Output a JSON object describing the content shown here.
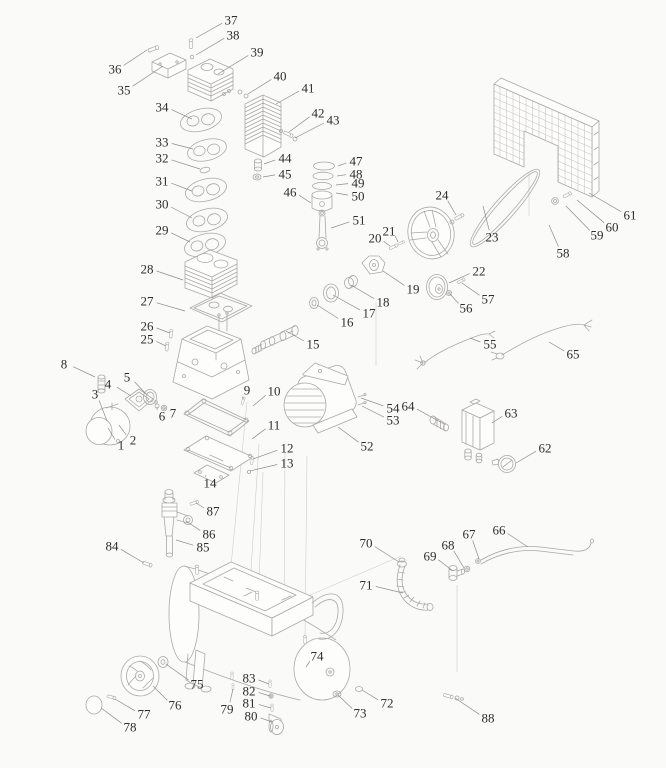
{
  "diagram": {
    "description_text": "",
    "background": "#fafaf8",
    "ink": "#aba9a6",
    "leader_color": "#8f8d8b",
    "label_color": "#2f2e2c",
    "part_labels": [
      {
        "n": "1",
        "x": 121,
        "y": 445,
        "tx": 108,
        "ty": 428
      },
      {
        "n": "2",
        "x": 133,
        "y": 440,
        "tx": 119,
        "ty": 425
      },
      {
        "n": "3",
        "x": 95,
        "y": 394,
        "tx": 107,
        "ty": 421
      },
      {
        "n": "4",
        "x": 108,
        "y": 384,
        "tx": 131,
        "ty": 396
      },
      {
        "n": "5",
        "x": 127,
        "y": 377,
        "tx": 146,
        "ty": 394
      },
      {
        "n": "6",
        "x": 162,
        "y": 416,
        "tx": 157,
        "ty": 407
      },
      {
        "n": "7",
        "x": 173,
        "y": 413,
        "tx": 165,
        "ty": 408
      },
      {
        "n": "8",
        "x": 64,
        "y": 364,
        "tx": 95,
        "ty": 377
      },
      {
        "n": "9",
        "x": 247,
        "y": 390,
        "tx": 243,
        "ty": 399
      },
      {
        "n": "10",
        "x": 274,
        "y": 391,
        "tx": 253,
        "ty": 406
      },
      {
        "n": "11",
        "x": 274,
        "y": 425,
        "tx": 252,
        "ty": 439
      },
      {
        "n": "12",
        "x": 287,
        "y": 448,
        "tx": 253,
        "ty": 459
      },
      {
        "n": "13",
        "x": 287,
        "y": 463,
        "tx": 250,
        "ty": 471
      },
      {
        "n": "14",
        "x": 210,
        "y": 483,
        "tx": 206,
        "ty": 475
      },
      {
        "n": "15",
        "x": 313,
        "y": 344,
        "tx": 286,
        "ty": 331
      },
      {
        "n": "16",
        "x": 347,
        "y": 322,
        "tx": 317,
        "ty": 305
      },
      {
        "n": "17",
        "x": 369,
        "y": 313,
        "tx": 333,
        "ty": 295
      },
      {
        "n": "18",
        "x": 383,
        "y": 302,
        "tx": 351,
        "ty": 285
      },
      {
        "n": "19",
        "x": 413,
        "y": 289,
        "tx": 383,
        "ty": 271
      },
      {
        "n": "20",
        "x": 375,
        "y": 238,
        "tx": 390,
        "ty": 246
      },
      {
        "n": "21",
        "x": 389,
        "y": 231,
        "tx": 398,
        "ty": 242
      },
      {
        "n": "22",
        "x": 479,
        "y": 271,
        "tx": 449,
        "ty": 283
      },
      {
        "n": "23",
        "x": 492,
        "y": 237,
        "tx": 483,
        "ty": 206
      },
      {
        "n": "24",
        "x": 442,
        "y": 195,
        "tx": 456,
        "ty": 215
      },
      {
        "n": "25",
        "x": 147,
        "y": 339,
        "tx": 166,
        "ty": 346
      },
      {
        "n": "26",
        "x": 147,
        "y": 326,
        "tx": 170,
        "ty": 333
      },
      {
        "n": "27",
        "x": 147,
        "y": 301,
        "tx": 185,
        "ty": 311
      },
      {
        "n": "28",
        "x": 147,
        "y": 269,
        "tx": 183,
        "ty": 280
      },
      {
        "n": "29",
        "x": 162,
        "y": 230,
        "tx": 190,
        "ty": 242
      },
      {
        "n": "30",
        "x": 162,
        "y": 204,
        "tx": 192,
        "ty": 218
      },
      {
        "n": "31",
        "x": 162,
        "y": 181,
        "tx": 192,
        "ty": 191
      },
      {
        "n": "32",
        "x": 162,
        "y": 158,
        "tx": 200,
        "ty": 169
      },
      {
        "n": "33",
        "x": 162,
        "y": 142,
        "tx": 193,
        "ty": 149
      },
      {
        "n": "34",
        "x": 162,
        "y": 107,
        "tx": 192,
        "ty": 119
      },
      {
        "n": "35",
        "x": 124,
        "y": 90,
        "tx": 163,
        "ty": 66
      },
      {
        "n": "36",
        "x": 115,
        "y": 69,
        "tx": 147,
        "ty": 50
      },
      {
        "n": "37",
        "x": 231,
        "y": 20,
        "tx": 196,
        "ty": 38
      },
      {
        "n": "38",
        "x": 233,
        "y": 35,
        "tx": 196,
        "ty": 55
      },
      {
        "n": "39",
        "x": 257,
        "y": 52,
        "tx": 218,
        "ty": 74
      },
      {
        "n": "40",
        "x": 280,
        "y": 76,
        "tx": 248,
        "ty": 94
      },
      {
        "n": "41",
        "x": 308,
        "y": 88,
        "tx": 276,
        "ty": 104
      },
      {
        "n": "42",
        "x": 318,
        "y": 113,
        "tx": 289,
        "ty": 132
      },
      {
        "n": "43",
        "x": 333,
        "y": 120,
        "tx": 295,
        "ty": 138
      },
      {
        "n": "44",
        "x": 285,
        "y": 158,
        "tx": 264,
        "ty": 164
      },
      {
        "n": "45",
        "x": 285,
        "y": 174,
        "tx": 263,
        "ty": 177
      },
      {
        "n": "46",
        "x": 290,
        "y": 192,
        "tx": 311,
        "ty": 203
      },
      {
        "n": "47",
        "x": 356,
        "y": 161,
        "tx": 338,
        "ty": 166
      },
      {
        "n": "48",
        "x": 356,
        "y": 174,
        "tx": 337,
        "ty": 176
      },
      {
        "n": "49",
        "x": 358,
        "y": 183,
        "tx": 336,
        "ty": 185
      },
      {
        "n": "50",
        "x": 358,
        "y": 196,
        "tx": 336,
        "ty": 193
      },
      {
        "n": "51",
        "x": 359,
        "y": 220,
        "tx": 331,
        "ty": 228
      },
      {
        "n": "52",
        "x": 367,
        "y": 446,
        "tx": 338,
        "ty": 427
      },
      {
        "n": "53",
        "x": 393,
        "y": 420,
        "tx": 362,
        "ty": 406
      },
      {
        "n": "54",
        "x": 393,
        "y": 408,
        "tx": 361,
        "ty": 398
      },
      {
        "n": "55",
        "x": 490,
        "y": 344,
        "tx": 470,
        "ty": 338
      },
      {
        "n": "56",
        "x": 466,
        "y": 308,
        "tx": 450,
        "ty": 294
      },
      {
        "n": "57",
        "x": 488,
        "y": 299,
        "tx": 462,
        "ty": 283
      },
      {
        "n": "58",
        "x": 563,
        "y": 253,
        "tx": 549,
        "ty": 225
      },
      {
        "n": "59",
        "x": 597,
        "y": 235,
        "tx": 566,
        "ty": 206
      },
      {
        "n": "60",
        "x": 612,
        "y": 227,
        "tx": 577,
        "ty": 200
      },
      {
        "n": "61",
        "x": 630,
        "y": 215,
        "tx": 589,
        "ty": 193
      },
      {
        "n": "62",
        "x": 545,
        "y": 448,
        "tx": 516,
        "ty": 463
      },
      {
        "n": "63",
        "x": 511,
        "y": 413,
        "tx": 492,
        "ty": 423
      },
      {
        "n": "64",
        "x": 408,
        "y": 406,
        "tx": 444,
        "ty": 424
      },
      {
        "n": "65",
        "x": 573,
        "y": 354,
        "tx": 549,
        "ty": 342
      },
      {
        "n": "66",
        "x": 499,
        "y": 530,
        "tx": 528,
        "ty": 547
      },
      {
        "n": "67",
        "x": 469,
        "y": 534,
        "tx": 479,
        "ty": 559
      },
      {
        "n": "68",
        "x": 448,
        "y": 545,
        "tx": 464,
        "ty": 568
      },
      {
        "n": "69",
        "x": 430,
        "y": 556,
        "tx": 453,
        "ty": 571
      },
      {
        "n": "70",
        "x": 366,
        "y": 543,
        "tx": 399,
        "ty": 562
      },
      {
        "n": "71",
        "x": 366,
        "y": 585,
        "tx": 403,
        "ty": 593
      },
      {
        "n": "72",
        "x": 387,
        "y": 703,
        "tx": 362,
        "ty": 690
      },
      {
        "n": "73",
        "x": 360,
        "y": 713,
        "tx": 338,
        "ty": 695
      },
      {
        "n": "74",
        "x": 317,
        "y": 656,
        "tx": 306,
        "ty": 667
      },
      {
        "n": "75",
        "x": 197,
        "y": 684,
        "tx": 166,
        "ty": 664
      },
      {
        "n": "76",
        "x": 175,
        "y": 705,
        "tx": 153,
        "ty": 686
      },
      {
        "n": "77",
        "x": 144,
        "y": 714,
        "tx": 115,
        "ty": 699
      },
      {
        "n": "78",
        "x": 130,
        "y": 727,
        "tx": 101,
        "ty": 708
      },
      {
        "n": "79",
        "x": 227,
        "y": 709,
        "tx": 233,
        "ty": 689
      },
      {
        "n": "80",
        "x": 251,
        "y": 716,
        "tx": 272,
        "ty": 722
      },
      {
        "n": "81",
        "x": 249,
        "y": 703,
        "tx": 271,
        "ty": 708
      },
      {
        "n": "82",
        "x": 249,
        "y": 691,
        "tx": 270,
        "ty": 696
      },
      {
        "n": "83",
        "x": 249,
        "y": 678,
        "tx": 269,
        "ty": 684
      },
      {
        "n": "84",
        "x": 112,
        "y": 546,
        "tx": 144,
        "ty": 563
      },
      {
        "n": "85",
        "x": 203,
        "y": 547,
        "tx": 176,
        "ty": 540
      },
      {
        "n": "86",
        "x": 209,
        "y": 534,
        "tx": 186,
        "ty": 521
      },
      {
        "n": "87",
        "x": 213,
        "y": 511,
        "tx": 196,
        "ty": 503
      },
      {
        "n": "88",
        "x": 488,
        "y": 718,
        "tx": 455,
        "ty": 698
      }
    ]
  }
}
